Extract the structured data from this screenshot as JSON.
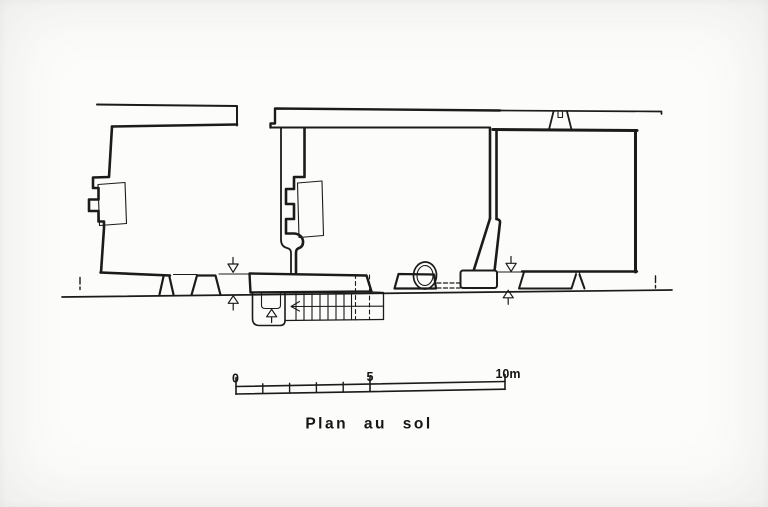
{
  "drawing": {
    "title": "Plan au sol",
    "kind": "architectural-ground-floor-plan"
  },
  "scale_bar": {
    "start_label": "0",
    "mid_label": "5",
    "end_label": "10m",
    "units_meters_total": 10
  },
  "colors": {
    "ink": "#1b1b19",
    "paper": "#fcfcfa"
  }
}
